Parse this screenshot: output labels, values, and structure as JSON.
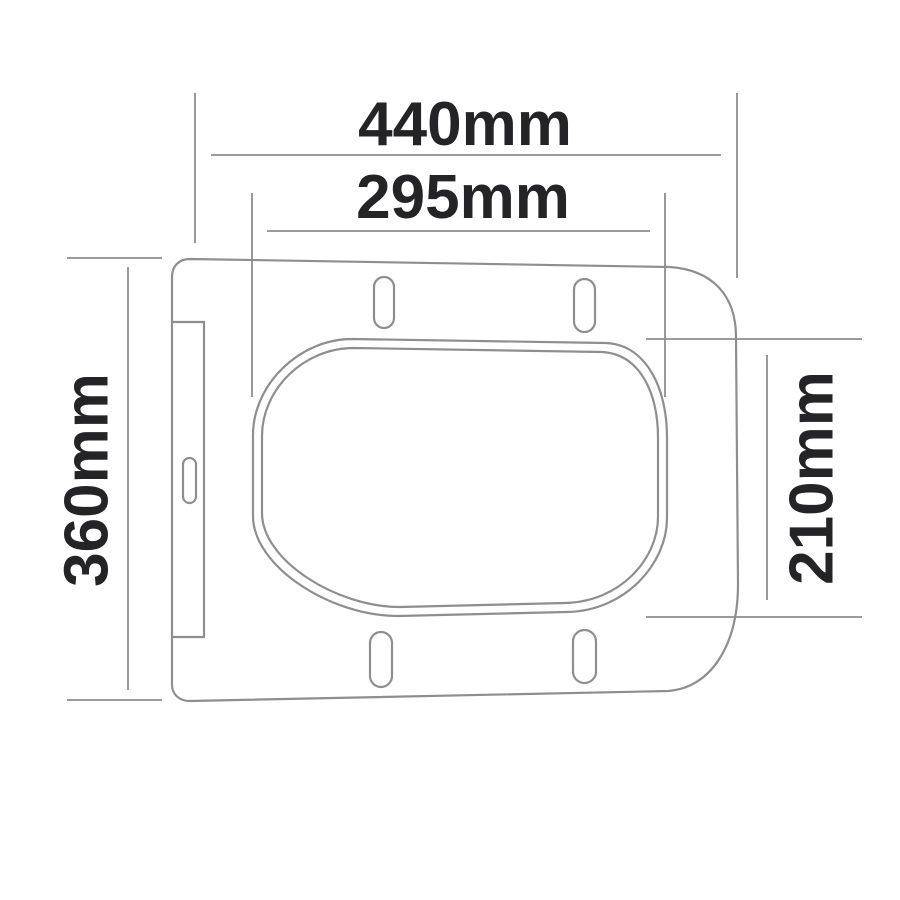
{
  "dimensions": {
    "overall_width": {
      "label": "440mm"
    },
    "opening_width": {
      "label": "295mm"
    },
    "overall_depth": {
      "label": "360mm"
    },
    "opening_depth": {
      "label": "210mm"
    }
  },
  "colors": {
    "background": "#ffffff",
    "line": "#8e8e91",
    "label_text": "#242426"
  }
}
